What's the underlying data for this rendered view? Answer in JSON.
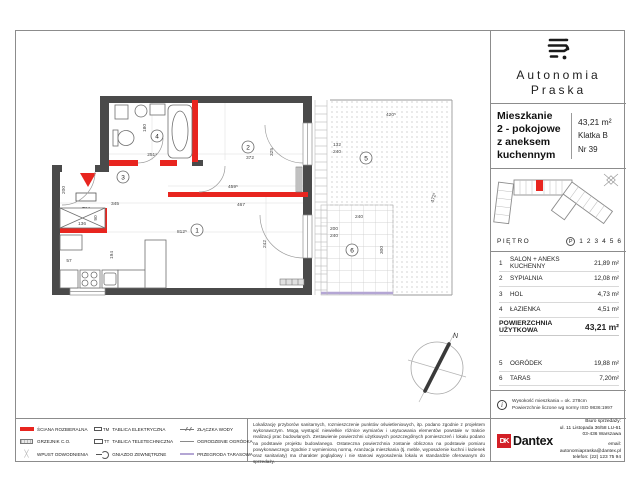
{
  "brand": {
    "name_line1": "Autonomia",
    "name_line2": "Praska"
  },
  "unit": {
    "kind_line1": "Mieszkanie",
    "kind_line2": "2 - pokojowe",
    "kind_line3": "z aneksem",
    "kind_line4": "kuchennym",
    "area": "43,21 m²",
    "staircase": "Klatka B",
    "number": "Nr 39"
  },
  "site": {
    "floor_label": "PIĘTRO",
    "selector_p": "P",
    "floors": [
      "1",
      "2",
      "3",
      "4",
      "5",
      "6"
    ]
  },
  "table": {
    "rows": [
      {
        "no": "1",
        "name": "SALON + ANEKS KUCHENNY",
        "area": "21,89 m²"
      },
      {
        "no": "2",
        "name": "SYPIALNIA",
        "area": "12,08 m²"
      },
      {
        "no": "3",
        "name": "HOL",
        "area": "4,73 m²"
      },
      {
        "no": "4",
        "name": "ŁAZIENKA",
        "area": "4,51 m²"
      }
    ],
    "total_label": "POWIERZCHNIA UŻYTKOWA",
    "total_area": "43,21 m²",
    "outdoor": [
      {
        "no": "5",
        "name": "OGRÓDEK",
        "area": "19,88 m²"
      },
      {
        "no": "6",
        "name": "TARAS",
        "area": "7,20m²"
      }
    ]
  },
  "note": {
    "line1": "Wysokość mieszkania = ok. 278cm",
    "line2": "Powierzchnie liczone wg normy ISO 9836:1997"
  },
  "legend": {
    "col1": [
      {
        "label": "ŚCIANA ROZBIERALNA"
      },
      {
        "label": "GRZEJNIK C.O."
      },
      {
        "label": "WPUST ODWODNIENIA"
      }
    ],
    "col2": [
      {
        "tag": "TM",
        "label": "TABLICA ELEKTRYCZNA"
      },
      {
        "tag": "TT",
        "label": "TABLICA TELETECHNICZNA"
      },
      {
        "label": "GNIAZDO ZEWNĘTRZNE"
      }
    ],
    "col3": [
      {
        "label": "ZŁĄCZKA WODY"
      },
      {
        "label": "OGRODZENIE OGRÓDKA"
      },
      {
        "label": "PRZEGRODA TARASOWA"
      }
    ]
  },
  "disclaimer": "Lokalizację przyborów sanitarnych, rozmieszczenie punktów oświetleniowych, itp. podano zgodnie z projektem wykonawczym. Mogą wystąpić niewielkie różnice wymiarów i usytuowania elementów powstałe w trakcie realizacji prac budowlanych. Zestawienie powierzchni użytkowych poszczególnych pomieszczeń i lokalu podano na podstawie projektu budowlanego. Ostateczna powierzchnia zostanie obliczona na podstawie pomiaru powykonawczego zgodnie z wymienioną normą. Aranżacja mieszkania (tj. meble, wyposażenie kuchni i łazienek oraz sanitariaty) ma charakter poglądowy i nie stanowi wyposażenia lokalu w standardzie oferowanym do sprzedaży.",
  "developer": {
    "name": "Dantex",
    "logo_mark": "DK",
    "office_title": "Biuro sprzedaży:",
    "address1": "ul. 11 Listopada 36/58 LU-61",
    "address2": "03-436 Warszawa",
    "email": "email: autonomiapraska@dantex.pl",
    "phone": "telefon: (22) 123 75 94"
  },
  "plan": {
    "north": "N",
    "tm": "TM",
    "rooms": {
      "r1": "1",
      "r2": "2",
      "r3": "3",
      "r4": "4",
      "r5": "5",
      "r6": "6"
    },
    "dims": {
      "hall": "345",
      "bath_w": "251¹",
      "bath_h": "180",
      "red_wall": "459⁵",
      "salon_top": "467",
      "salon_w": "812⁵",
      "salon_h": "242",
      "bed_w": "372",
      "bed_h": "325",
      "wardrobe_w": "136",
      "wardrobe_h": "90",
      "shaft": "57",
      "kitchen": "194",
      "entry": "200",
      "garden_w": "420⁵",
      "garden_h": "472⁵",
      "terrace_w": "240",
      "terrace_h": "300",
      "tdoor_w": "200",
      "tdoor_h": "240",
      "gwin_w": "132",
      "gwin_h": "240"
    }
  }
}
